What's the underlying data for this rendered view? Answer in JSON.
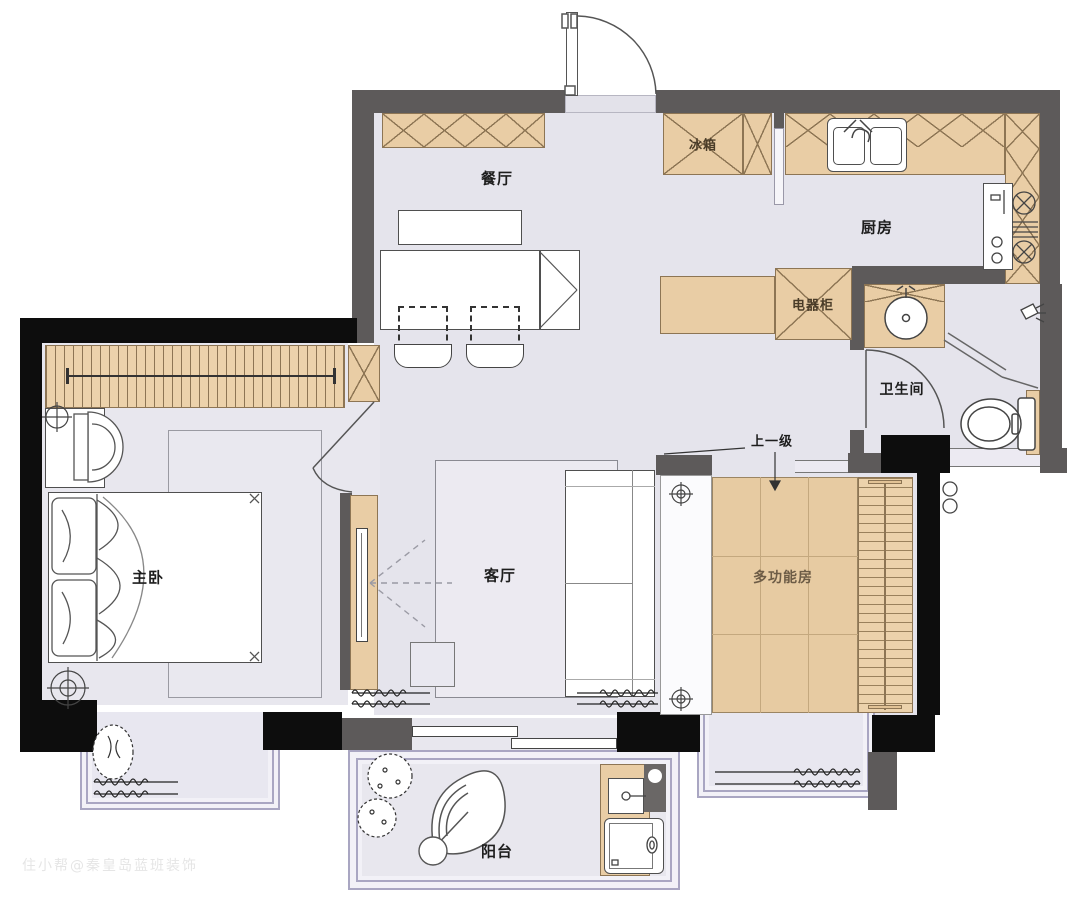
{
  "plan_title": "apartment-floor-plan",
  "rooms": {
    "dining": "餐厅",
    "kitchen": "厨房",
    "bathroom": "卫生间",
    "master_bedroom": "主卧",
    "living": "客厅",
    "multi_room": "多功能房",
    "balcony": "阳台"
  },
  "fixtures": {
    "fridge": "冰箱",
    "appliance_cabinet": "电器柜"
  },
  "annotations": {
    "step_up": "上一级"
  },
  "watermark": "住小帮@秦皇岛蓝班装饰",
  "colors": {
    "wall_gray": "#5d5a5a",
    "wall_black": "#0d0d0d",
    "floor": "#e5e4ec",
    "floor_bedroom": "#e8e7ee",
    "cabinet_tan": "#e9cda5",
    "cabinet_line": "#8d7554",
    "window_frame": "#a9a6c2",
    "outline": "#4a4a4a"
  },
  "symbols": {
    "downlight": "crosshair-circle-icon",
    "shower": "shower-head-icon",
    "step_arrow": "down-arrow-icon"
  }
}
